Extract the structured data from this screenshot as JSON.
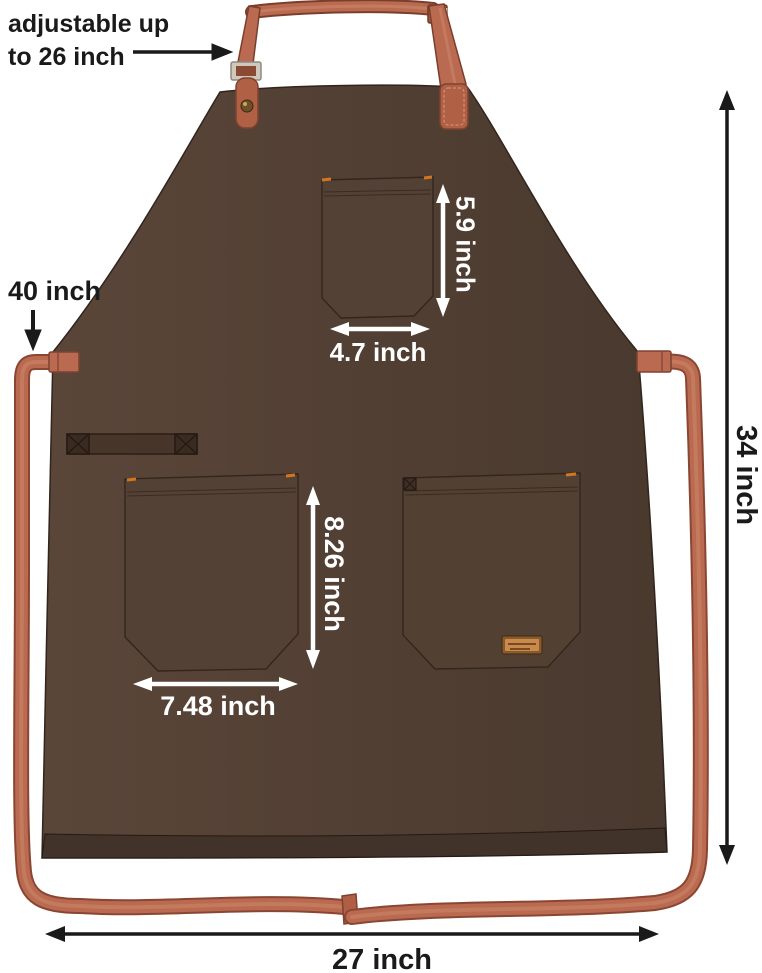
{
  "annotations": {
    "neck": {
      "label": "adjustable up\nto 26 inch"
    },
    "waist_tie": {
      "label": "40 inch"
    },
    "chest_pocket": {
      "height_label": "5.9 inch",
      "width_label": "4.7 inch"
    },
    "front_pocket": {
      "height_label": "8.26 inch",
      "width_label": "7.48 inch"
    },
    "overall": {
      "height_label": "34 inch",
      "width_label": "27 inch"
    }
  },
  "colors": {
    "background": "#ffffff",
    "apron_body": "#523f33",
    "apron_hem": "#41322a",
    "strap": "#b96a50",
    "strap_dark": "#8a4632",
    "stitch_orange": "#d4761f",
    "brand_label_tan": "#c98a4e",
    "annotation_dark": "#1a1a1a",
    "annotation_light": "#ffffff"
  }
}
